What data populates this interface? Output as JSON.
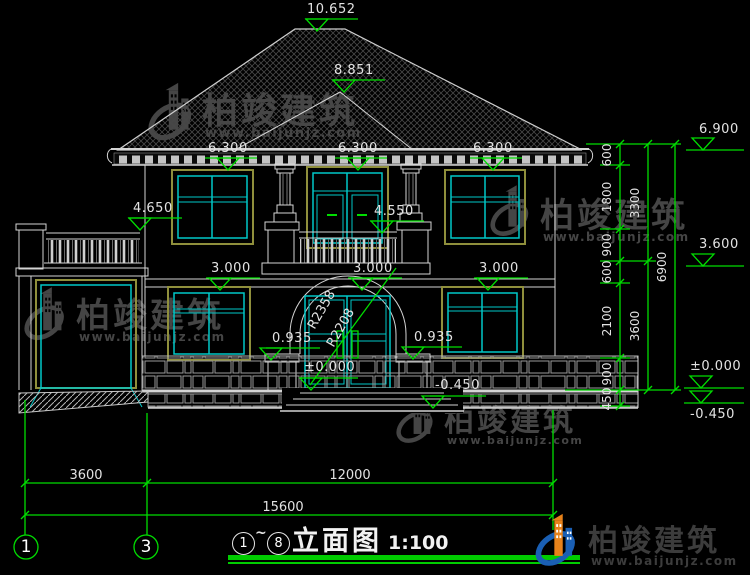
{
  "watermark": {
    "brand": "柏竣建筑",
    "site": "www.baijunjz.com"
  },
  "title": {
    "from": "1",
    "tilde": "~",
    "to": "8",
    "name": "立面图",
    "scale": "1:100"
  },
  "grid": {
    "left": "1",
    "right": "3"
  },
  "elev": {
    "ridge": "10.652",
    "hip": "8.851",
    "eave1": "6.300",
    "eave2": "6.300",
    "eave3": "6.300",
    "parapet": "4.650",
    "balcony": "4.550",
    "floor1": "3.000",
    "floor2": "3.000",
    "floor3": "3.000",
    "sill_l": "0.935",
    "sill_r": "0.935",
    "entry": "±0.000",
    "grade": "-0.450",
    "r_top": "6.900",
    "r_mid": "3.600",
    "r_floor": "±0.000",
    "r_grade": "-0.450"
  },
  "radius": {
    "outer": "R2358",
    "inner": "R2208"
  },
  "dims_v": {
    "s1": "600",
    "s2": "1800",
    "s3": "900",
    "s4": "600",
    "s5": "2100",
    "s6": "900",
    "s7": "450",
    "t1": "3300",
    "t2": "3600",
    "total": "6900"
  },
  "dims_h": {
    "left": "3600",
    "right": "12000",
    "total": "15600"
  },
  "colors": {
    "annotation_green": "#00dd00",
    "line_white": "#d4d4d4",
    "frame_cyan": "#00c8c8",
    "frame_olive": "#8f8f3c",
    "watermark_gray": "#454545",
    "logo_blue": "#1a5fb4",
    "logo_orange": "#e8821a"
  }
}
